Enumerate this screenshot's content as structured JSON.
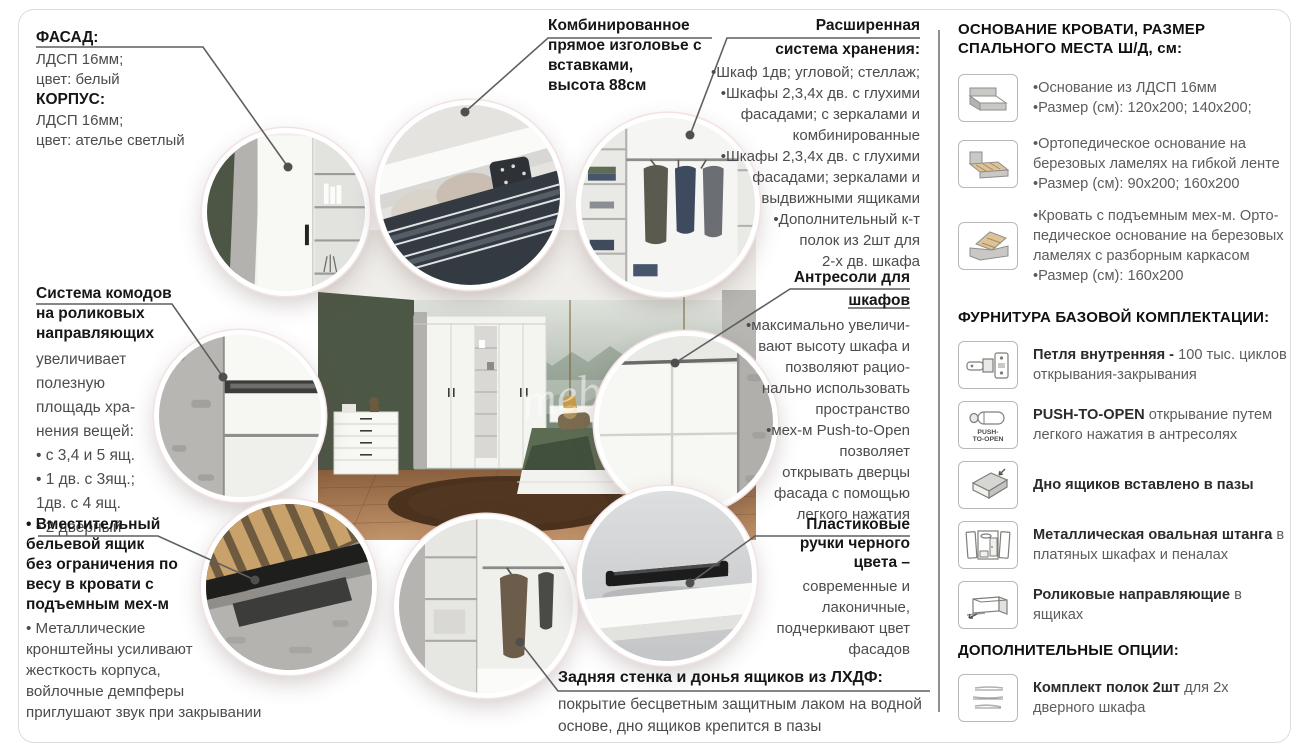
{
  "watermark": "mebel.ru",
  "colors": {
    "wall_green": "#4d5746",
    "concrete": "#b5b4b1",
    "blanket_green": "#5c6c53",
    "rug_brown": "#4a321f",
    "line_gray": "#5f5f5f",
    "handle_black": "#1c1c1c"
  },
  "callouts": {
    "facade": {
      "title1": "ФАСАД:",
      "body1": "ЛДСП 16мм;\nцвет: белый",
      "title2": "КОРПУС:",
      "body2": "ЛДСП 16мм;\nцвет: ателье светлый"
    },
    "headboard": {
      "title": "Комбинированное\nпрямое изголовье с\nвставками,\nвысота 88см"
    },
    "storage": {
      "title1": "Расширенная",
      "title2": "система хранения:",
      "items": "•Шкаф 1дв; угловой; стеллаж;\n•Шкафы 2,3,4х дв. с глухими\nфасадами; с зеркалами и\nкомбинированные\n•Шкафы 2,3,4х дв. с глухими\nфасадами; зеркалами и\nвыдвижными ящиками\n•Дополнительный к-т\nполок из 2шт для\n2-х дв. шкафа"
    },
    "antresol": {
      "title1": "Антресоли для",
      "title2": "шкафов",
      "items": "•максимально увеличи-\nвают высоту шкафа и\nпозволяют рацио-\nнально использовать\nпространство\n•мех-м Push-to-Open\nпозволяет\nоткрывать дверцы\nфасада с помощью\nлегкого нажатия"
    },
    "chest": {
      "title": "Система комодов\nна роликовых\nнаправляющих",
      "body": "увеличивает\nполезную\nплощадь хра-\nнения вещей:\n• с 3,4 и 5 ящ.\n• 1 дв. с 3ящ.;\n1дв. с 4 ящ.\n• 2 дверный"
    },
    "linen": {
      "title": "• Вместительный\nбельевой ящик\nбез ограничения по\nвесу в кровати с\nподъемным мех-м",
      "body": "• Металлические\nкронштейны усиливают\nжесткость корпуса,\nвойлочные демпферы\nприглушают звук при закрывании"
    },
    "handles": {
      "title": "Пластиковые\nручки черного\nцвета –",
      "body": "современные и\nлаконичные,\nподчеркивают цвет\nфасадов"
    },
    "backwall": {
      "title": "Задняя стенка и донья ящиков из ЛХДФ:",
      "body": "покрытие бесцветным защитным лаком на водной\nоснове, дно ящиков крепится в пазы"
    }
  },
  "panel": {
    "bed_title": "ОСНОВАНИЕ КРОВАТИ, РАЗМЕР\nСПАЛЬНОГО МЕСТА Ш/Д, см:",
    "beds": [
      {
        "icon": "bed-flat-icon",
        "text": "•Основание из ЛДСП 16мм\n•Размер (см): 120x200; 140x200;"
      },
      {
        "icon": "bed-lamels-icon",
        "text": "•Ортопедическое основание на\nберезовых ламелях на гибкой ленте\n•Размер (см): 90x200; 160x200"
      },
      {
        "icon": "bed-lift-icon",
        "text": "•Кровать с подъемным мех-м. Орто-\nпедическое основание на березовых\nламелях с разборным каркасом\n•Размер (см): 160x200"
      }
    ],
    "hw_title": "ФУРНИТУРА БАЗОВОЙ КОМПЛЕКТАЦИИ:",
    "hw": [
      {
        "icon": "hinge-icon",
        "bold": "Петля внутренняя - ",
        "rest": "100 тыс. циклов открывания-закрывания"
      },
      {
        "icon": "push-to-open-icon",
        "bold": "PUSH-TO-OPEN ",
        "rest": "открывание путем легкого нажатия в антресолях"
      },
      {
        "icon": "drawer-bottom-icon",
        "bold": "Дно ящиков вставлено в пазы",
        "rest": ""
      },
      {
        "icon": "wardrobe-rod-icon",
        "bold": "Металлическая овальная штанга",
        "rest": " в платяных шкафах и пеналах"
      },
      {
        "icon": "roller-guides-icon",
        "bold": "Роликовые направляющие",
        "rest": " в ящиках"
      }
    ],
    "opt_title": "ДОПОЛНИТЕЛЬНЫЕ ОПЦИИ:",
    "options": [
      {
        "icon": "shelf-set-icon",
        "bold": "Комплект полок 2шт",
        "rest": " для 2х дверного шкафа"
      }
    ],
    "push_label": "PUSH-\nTO-OPEN"
  }
}
